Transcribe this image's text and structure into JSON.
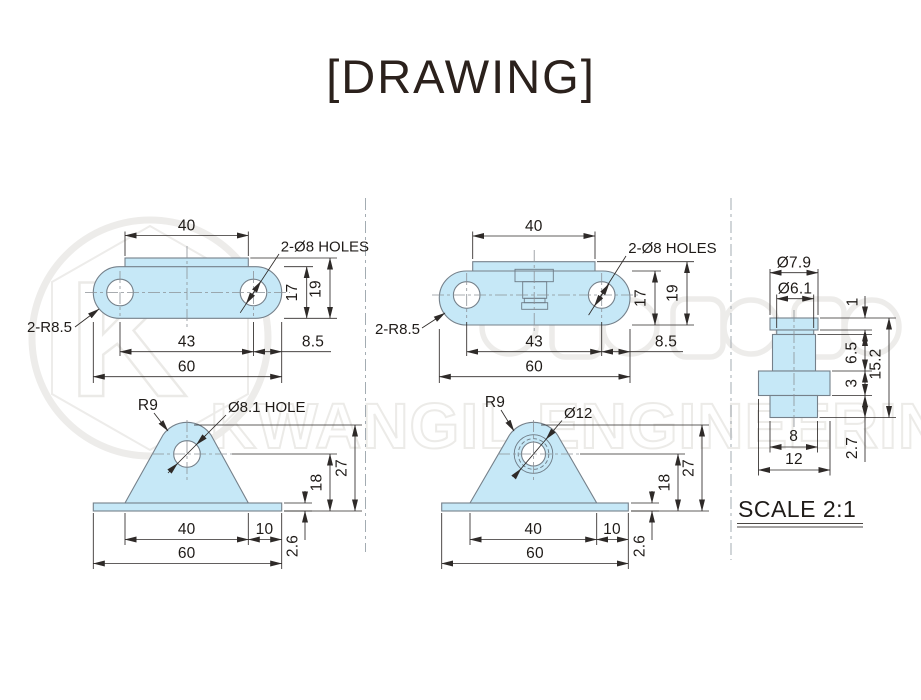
{
  "title": "[DRAWING]",
  "scale_label": "SCALE 2:1",
  "watermark": {
    "logo_letter": "K",
    "company": "KWANGIL ENGINEERING"
  },
  "colors": {
    "part_fill": "#c6e8f7",
    "part_outline": "#75808a",
    "dimension": "#2e2a28",
    "title_text": "#2b211c",
    "watermark": "#edecea",
    "background": "#ffffff"
  },
  "views": {
    "top_left_plate": {
      "width_top": "40",
      "holes_note": "2-Ø8 HOLES",
      "height_inner": "17",
      "height_total": "19",
      "corner_radius": "2-R8.5",
      "hole_spacing": "43",
      "edge_offset": "8.5",
      "width_total": "60"
    },
    "top_mid_plate": {
      "width_top": "40",
      "holes_note": "2-Ø8 HOLES",
      "height_inner": "17",
      "height_total": "19",
      "corner_radius": "2-R8.5",
      "hole_spacing": "43",
      "edge_offset": "8.5",
      "width_total": "60"
    },
    "front_left_bracket": {
      "apex_radius": "R9",
      "hole_note": "Ø8.1 HOLE",
      "height_total": "27",
      "hole_height": "18",
      "plate_thickness": "2.6",
      "base_width": "40",
      "base_offset": "10",
      "width_total": "60"
    },
    "front_mid_bracket": {
      "apex_radius": "R9",
      "hole_note": "Ø12",
      "height_total": "27",
      "hole_height": "18",
      "plate_thickness": "2.6",
      "base_width": "40",
      "base_offset": "10",
      "width_total": "60"
    },
    "stud_detail": {
      "dia_outer": "Ø7.9",
      "dia_groove": "Ø6.1",
      "cap_height": "1",
      "body_height": "6.5",
      "flange_height": "3",
      "total_height": "15.2",
      "pin_height": "2.7",
      "pin_width": "8",
      "flange_width": "12"
    }
  }
}
